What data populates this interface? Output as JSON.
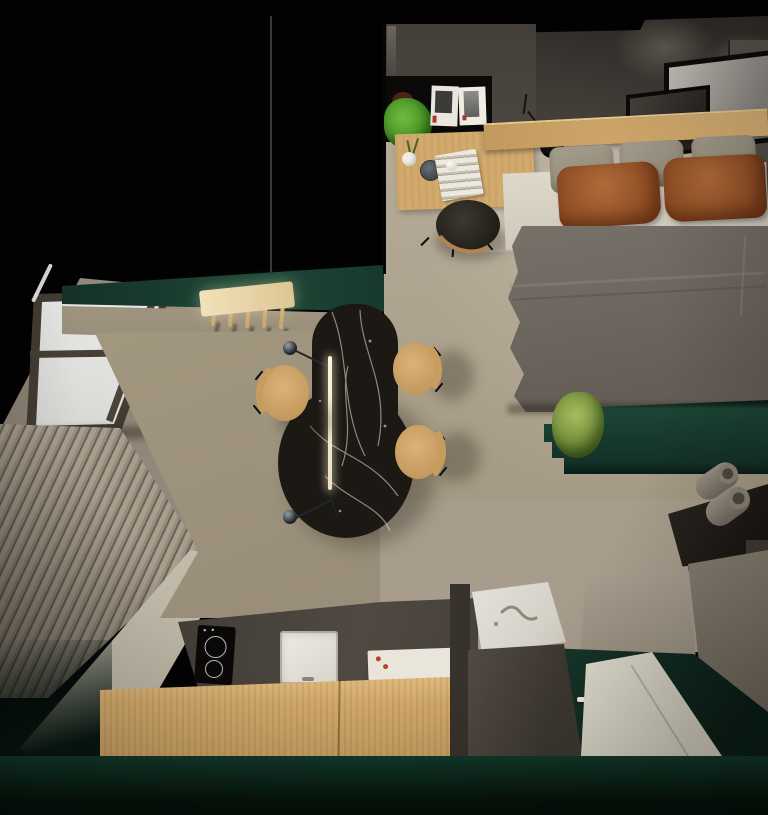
{
  "meta": {
    "title": "Top-down 3D render of a studio apartment"
  },
  "colors": {
    "void": "#020202",
    "wall-top": "#47423c",
    "wall-desk": "#4c4741",
    "wall-tan": "#a0957f",
    "wall-right": "#564f48",
    "wall-bath-beige": "#a3998b",
    "wall-bath-gray": "#7d756a",
    "green-wall": "#17362c",
    "green-bench": "#1b4234",
    "green-floor": "#123028",
    "roof-beige": "#a0968a",
    "slat-light": "#a89e8e",
    "slat-dark": "#6b6356",
    "floor-bed": "#b2a795",
    "floor-dining": "#9c9180",
    "floor-strip": "#c9c2b2",
    "wood": "#d2aa6e",
    "wood-deep": "#c0955a",
    "plank": "#cba367",
    "marble": "#1c1814",
    "vein": "#e9e5dc",
    "duvet": "#6f6961",
    "sheet": "#dad4c7",
    "pillow-gray": "#9c9584",
    "rust": "#9e5a30",
    "rust-dark": "#7a421f",
    "counter": "#46413a",
    "cooktop": "#0a0908",
    "white-fixture": "#e9e5dc",
    "shower": "#d6d1c4",
    "shelf-black": "#0c0a09",
    "plant": "#58a62e",
    "plant-olive": "#8fae4e",
    "lamp": "#141414",
    "frame": "#0d0c0a",
    "glass": "#e7e7e5",
    "glow": "#f6ecd4",
    "roll": "#948b7e"
  },
  "scene": {
    "view": "top-down render, no visible text",
    "zones": [
      {
        "name": "bedroom",
        "items": [
          {
            "name": "double-bed",
            "gray_pillows": 3,
            "rust_pillows": 2,
            "sheet": "white",
            "duvet": "gray"
          },
          {
            "name": "headboard-shelf",
            "material": "light wood"
          },
          {
            "name": "leaning-art-frames",
            "count": 2
          },
          {
            "name": "bedside-rug"
          }
        ]
      },
      {
        "name": "workspace",
        "items": [
          {
            "name": "black-wall-shelf",
            "contents": [
              "potted-green-plant",
              "magazines"
            ],
            "magazines": 2
          },
          {
            "name": "wooden-desk",
            "contents": [
              "vase-with-sprig",
              "round-canister",
              "paper-stack",
              "small-ball"
            ]
          },
          {
            "name": "upholstered-stool"
          },
          {
            "name": "black-wall-lamp"
          }
        ]
      },
      {
        "name": "dining",
        "items": [
          {
            "name": "black-marble-teardrop-table"
          },
          {
            "name": "linear-pendant-light",
            "counterweight-spheres": 2,
            "ceiling-cord": 1
          },
          {
            "name": "wooden-chair",
            "count": 3
          },
          {
            "name": "coat-rack",
            "pegs": 5
          }
        ]
      },
      {
        "name": "kitchen",
        "items": [
          {
            "name": "dark-counter",
            "contents": [
              "induction-cooktop",
              "white-sink",
              "white-tray-with-red-dots"
            ],
            "cooktop_burners": 2
          },
          {
            "name": "wooden-island-front"
          }
        ]
      },
      {
        "name": "bathroom",
        "items": [
          {
            "name": "vanity-marble-top"
          },
          {
            "name": "vanity-cabinet"
          },
          {
            "name": "white-shower-tray"
          },
          {
            "name": "towel-shelf",
            "rolls": 2
          },
          {
            "name": "white-door-handle"
          }
        ]
      },
      {
        "name": "attic-side",
        "items": [
          {
            "name": "sloped-roof"
          },
          {
            "name": "skylight-window",
            "panes": 2
          },
          {
            "name": "slatted-wall"
          },
          {
            "name": "green-bench-at-bed-foot",
            "plant": 1
          }
        ]
      }
    ]
  }
}
